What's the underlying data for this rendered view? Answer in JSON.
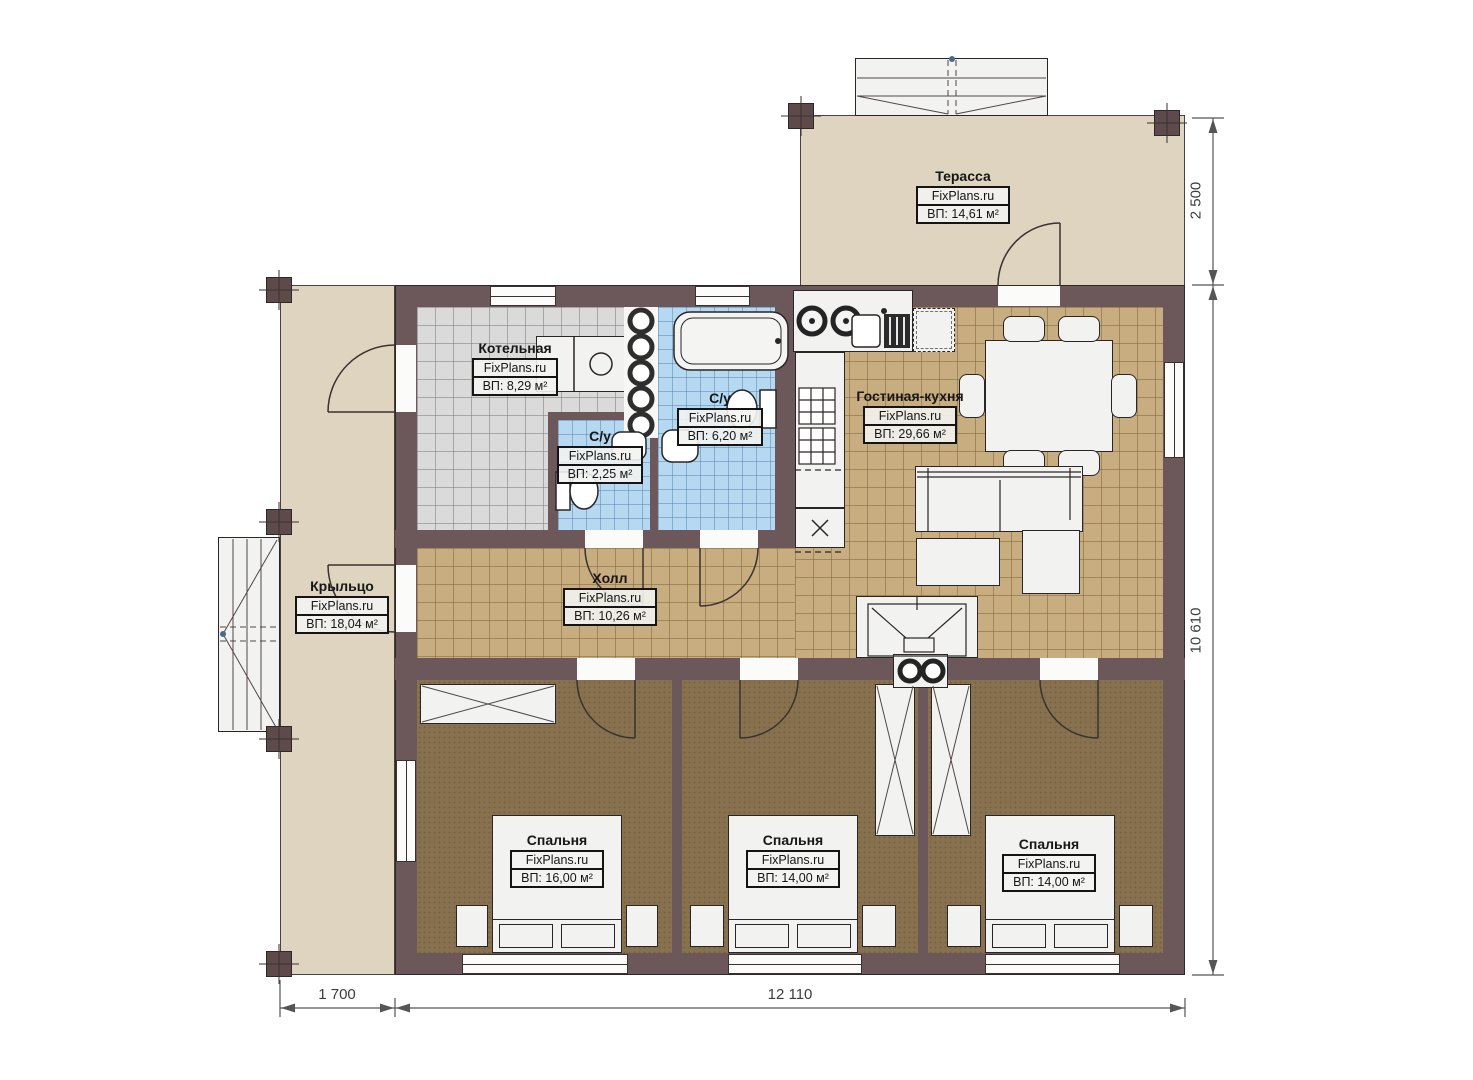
{
  "brand": "FixPlans.ru",
  "rooms": [
    {
      "id": "terrace",
      "name": "Терасса",
      "area": "ВП: 14,61 м²"
    },
    {
      "id": "boiler",
      "name": "Котельная",
      "area": "ВП: 8,29 м²"
    },
    {
      "id": "bath-small",
      "name": "С/у",
      "area": "ВП: 2,25 м²"
    },
    {
      "id": "bath-big",
      "name": "С/у",
      "area": "ВП: 6,20 м²"
    },
    {
      "id": "living-kitchen",
      "name": "Гостиная-кухня",
      "area": "ВП: 29,66 м²"
    },
    {
      "id": "hall",
      "name": "Холл",
      "area": "ВП: 10,26 м²"
    },
    {
      "id": "porch",
      "name": "Крыльцо",
      "area": "ВП: 18,04 м²"
    },
    {
      "id": "bedroom-1",
      "name": "Спальня",
      "area": "ВП: 16,00 м²"
    },
    {
      "id": "bedroom-2",
      "name": "Спальня",
      "area": "ВП: 14,00 м²"
    },
    {
      "id": "bedroom-3",
      "name": "Спальня",
      "area": "ВП: 14,00 м²"
    }
  ],
  "dimensions": {
    "terrace_depth": "2 500",
    "house_height": "10 610",
    "porch_width": "1 700",
    "house_width": "12 110"
  },
  "colors": {
    "wall": "#6c585a",
    "floor_tile_tan": "#c7ad7f",
    "floor_bedroom": "#87714f",
    "floor_boiler": "#dadada",
    "floor_bath": "#b7d8f1",
    "floor_outdoor": "#ded4c0"
  }
}
